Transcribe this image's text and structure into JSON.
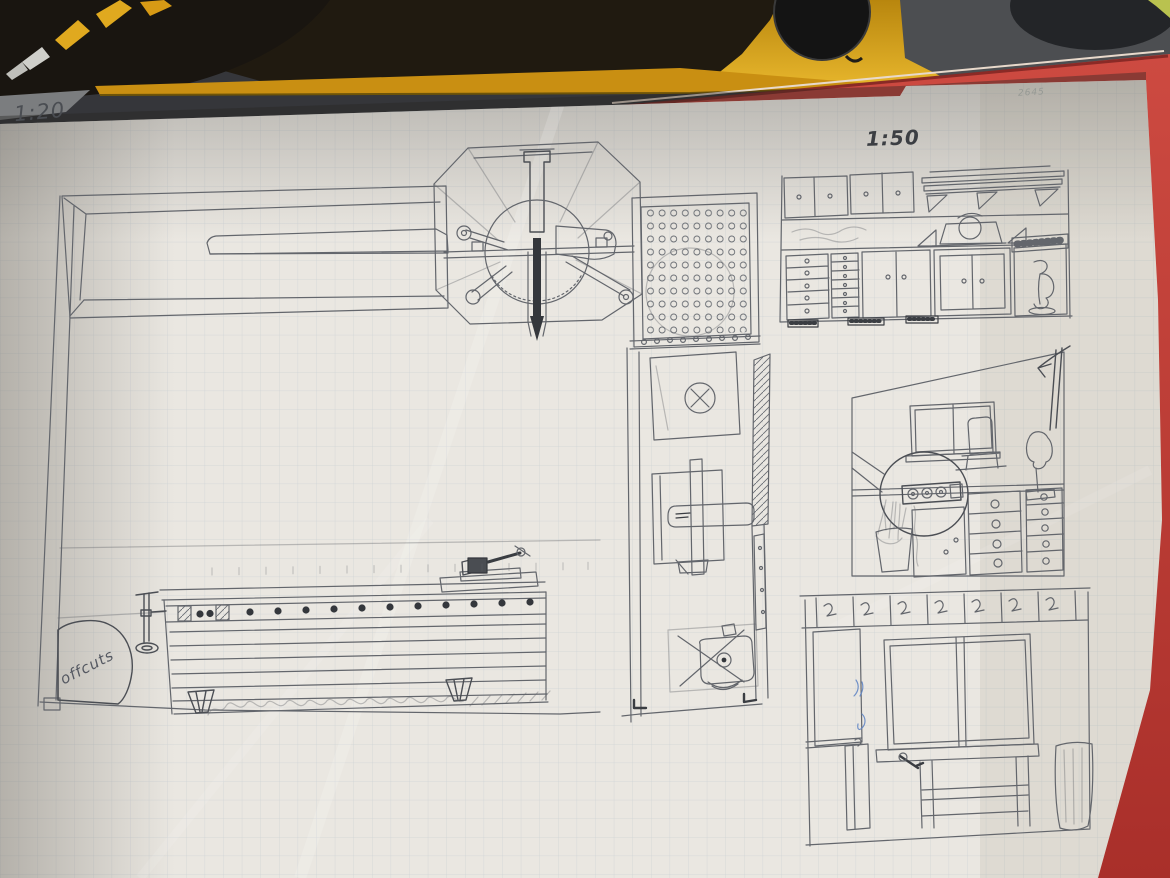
{
  "scene": {
    "description": "Photograph of hand-drawn pencil workshop plans (floor plan and wall elevations) on gridded paper, lying on a table below a mitre saw and on a red folder"
  },
  "annotations": {
    "scale_main": "1:20",
    "scale_detail": "1:50",
    "offcuts_label": "offcuts",
    "corner_note": "2645"
  },
  "drawings": [
    "long-bench-plan",
    "mitre-station-plan",
    "pegboard",
    "storage-wall-elevation",
    "power-strip-detail-elevation",
    "middle-room-plan-with-chair",
    "window-wall-elevation",
    "workbench-elevation",
    "offcuts-bin"
  ],
  "colors": {
    "saw_body_yellow": "#c98f12",
    "blade_dark": "#17130c",
    "machine_grey": "#4c4e51",
    "folder_red": "#c23b36",
    "paper": "#eae7e1",
    "grid_line": "#b6c0c9",
    "pencil": "#5f6368",
    "pencil_dark": "#34373c",
    "pen_blue": "#5b82c4",
    "table_grey": "#7b7d7f",
    "green_sliver": "#b9c24f"
  }
}
